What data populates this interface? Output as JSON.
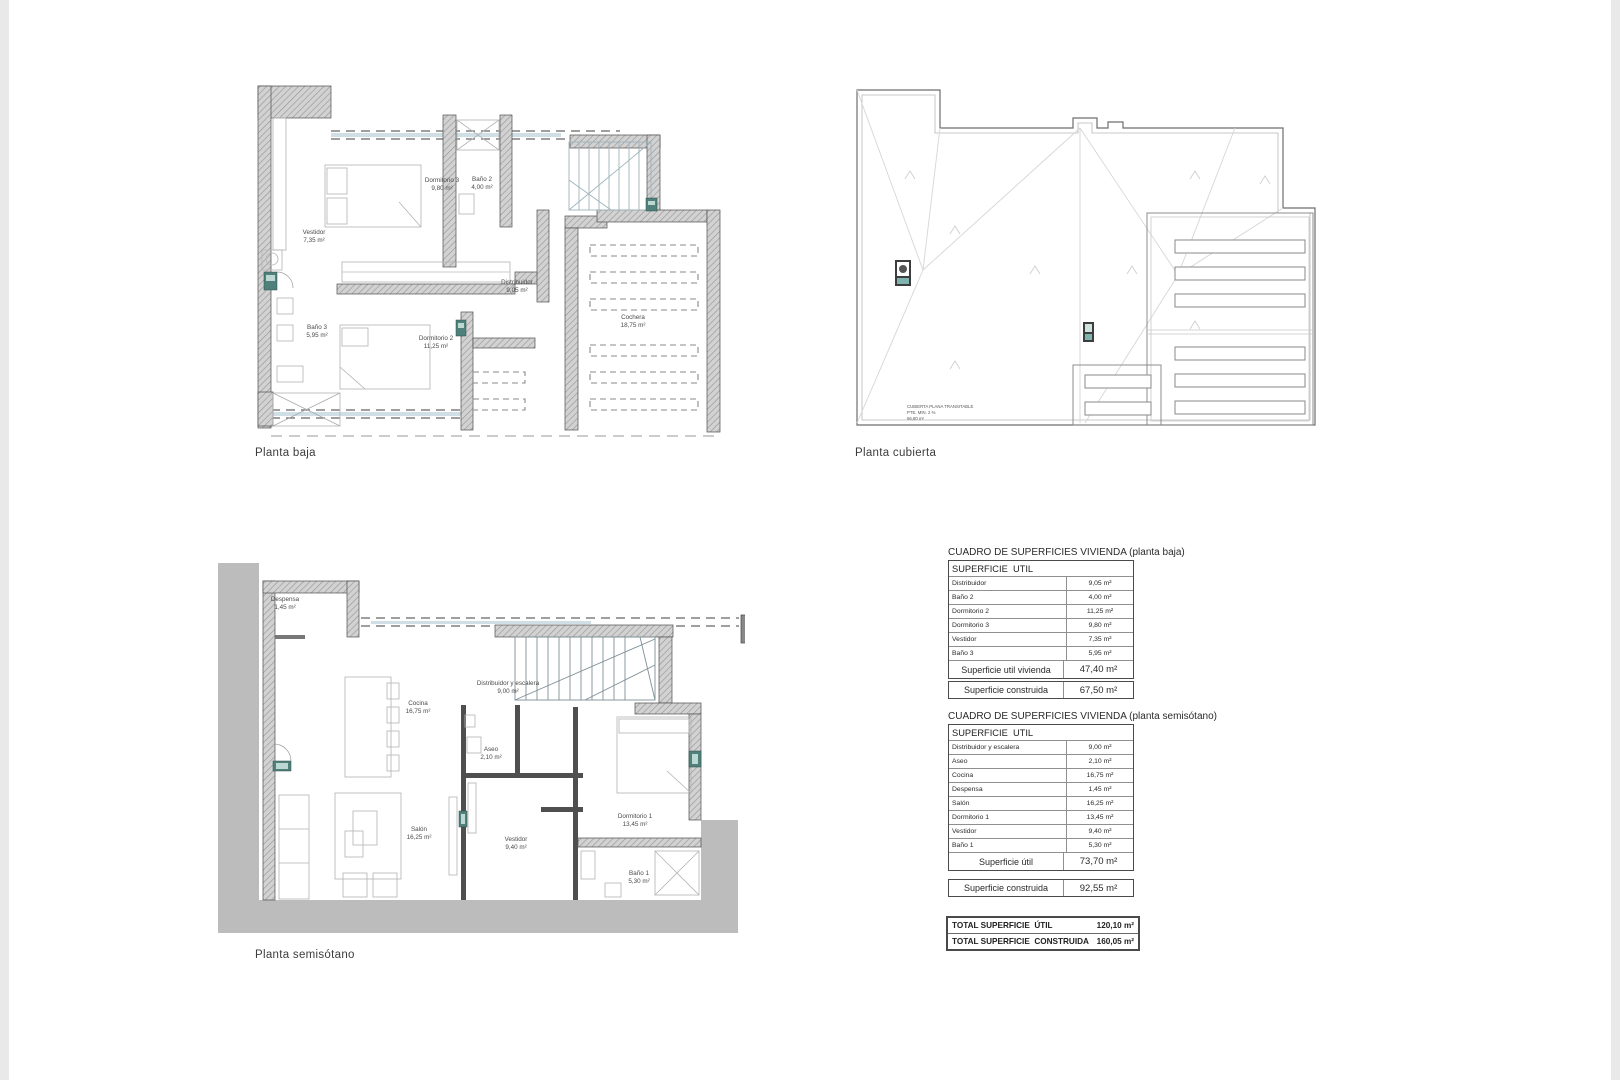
{
  "captions": {
    "baja": "Planta baja",
    "cubierta": "Planta cubierta",
    "semisotano": "Planta semisótano"
  },
  "plan_baja": {
    "rooms": [
      {
        "name": "Dormitorio 3",
        "area": "9,80 m²"
      },
      {
        "name": "Baño 2",
        "area": "4,00 m²"
      },
      {
        "name": "Vestidor",
        "area": "7,35 m²"
      },
      {
        "name": "Baño 3",
        "area": "5,95 m²"
      },
      {
        "name": "Dormitorio 2",
        "area": "11,25 m²"
      },
      {
        "name": "Distribuidor",
        "area": "9,05 m²"
      },
      {
        "name": "Cochera",
        "area": "18,75 m²"
      }
    ]
  },
  "plan_cubierta": {
    "note_line1": "CUBIERTA PLANA TRANSITABLE",
    "note_line2": "PTE. MIN. 2 %",
    "note_line3": "56,80 m²"
  },
  "plan_semisotano": {
    "rooms": [
      {
        "name": "Despensa",
        "area": "1,45 m²"
      },
      {
        "name": "Cocina",
        "area": "16,75 m²"
      },
      {
        "name": "Distribuidor y escalera",
        "area": "9,00 m²"
      },
      {
        "name": "Aseo",
        "area": "2,10 m²"
      },
      {
        "name": "Salón",
        "area": "16,25 m²"
      },
      {
        "name": "Vestidor",
        "area": "9,40 m²"
      },
      {
        "name": "Dormitorio 1",
        "area": "13,45 m²"
      },
      {
        "name": "Baño 1",
        "area": "5,30 m²"
      }
    ]
  },
  "tables": {
    "baja": {
      "title": "CUADRO DE SUPERFICIES VIVIENDA (planta baja)",
      "header": "SUPERFICIE  UTIL",
      "rows": [
        [
          "Distribuidor",
          "9,05 m²"
        ],
        [
          "Baño 2",
          "4,00 m²"
        ],
        [
          "Dormitorio 2",
          "11,25 m²"
        ],
        [
          "Dormitorio 3",
          "9,80 m²"
        ],
        [
          "Vestidor",
          "7,35 m²"
        ],
        [
          "Baño 3",
          "5,95 m²"
        ]
      ],
      "footer_label": "Superficie util vivienda",
      "footer_value": "47,40 m²",
      "construida_label": "Superficie construida",
      "construida_value": "67,50 m²"
    },
    "semisotano": {
      "title": "CUADRO DE SUPERFICIES VIVIENDA (planta semisótano)",
      "header": "SUPERFICIE  UTIL",
      "rows": [
        [
          "Distribuidor y escalera",
          "9,00 m²"
        ],
        [
          "Aseo",
          "2,10 m²"
        ],
        [
          "Cocina",
          "16,75 m²"
        ],
        [
          "Despensa",
          "1,45 m²"
        ],
        [
          "Salón",
          "16,25 m²"
        ],
        [
          "Dormitorio 1",
          "13,45 m²"
        ],
        [
          "Vestidor",
          "9,40 m²"
        ],
        [
          "Baño 1",
          "5,30 m²"
        ]
      ],
      "footer_label": "Superficie útil",
      "footer_value": "73,70 m²",
      "construida_label": "Superficie construida",
      "construida_value": "92,55 m²"
    },
    "totals": {
      "util_label": "TOTAL SUPERFICIE  ÚTIL",
      "util_value": "120,10 m²",
      "construida_label": "TOTAL SUPERFICIE  CONSTRUIDA",
      "construida_value": "160,05 m²"
    }
  },
  "colors": {
    "wall_hatch": "#d2d2d2",
    "wall_line": "#4f4f4f",
    "door_teal": "#50807b",
    "section_glazing": "#cfdfe5",
    "retaining_gray": "#bcbcbc"
  }
}
